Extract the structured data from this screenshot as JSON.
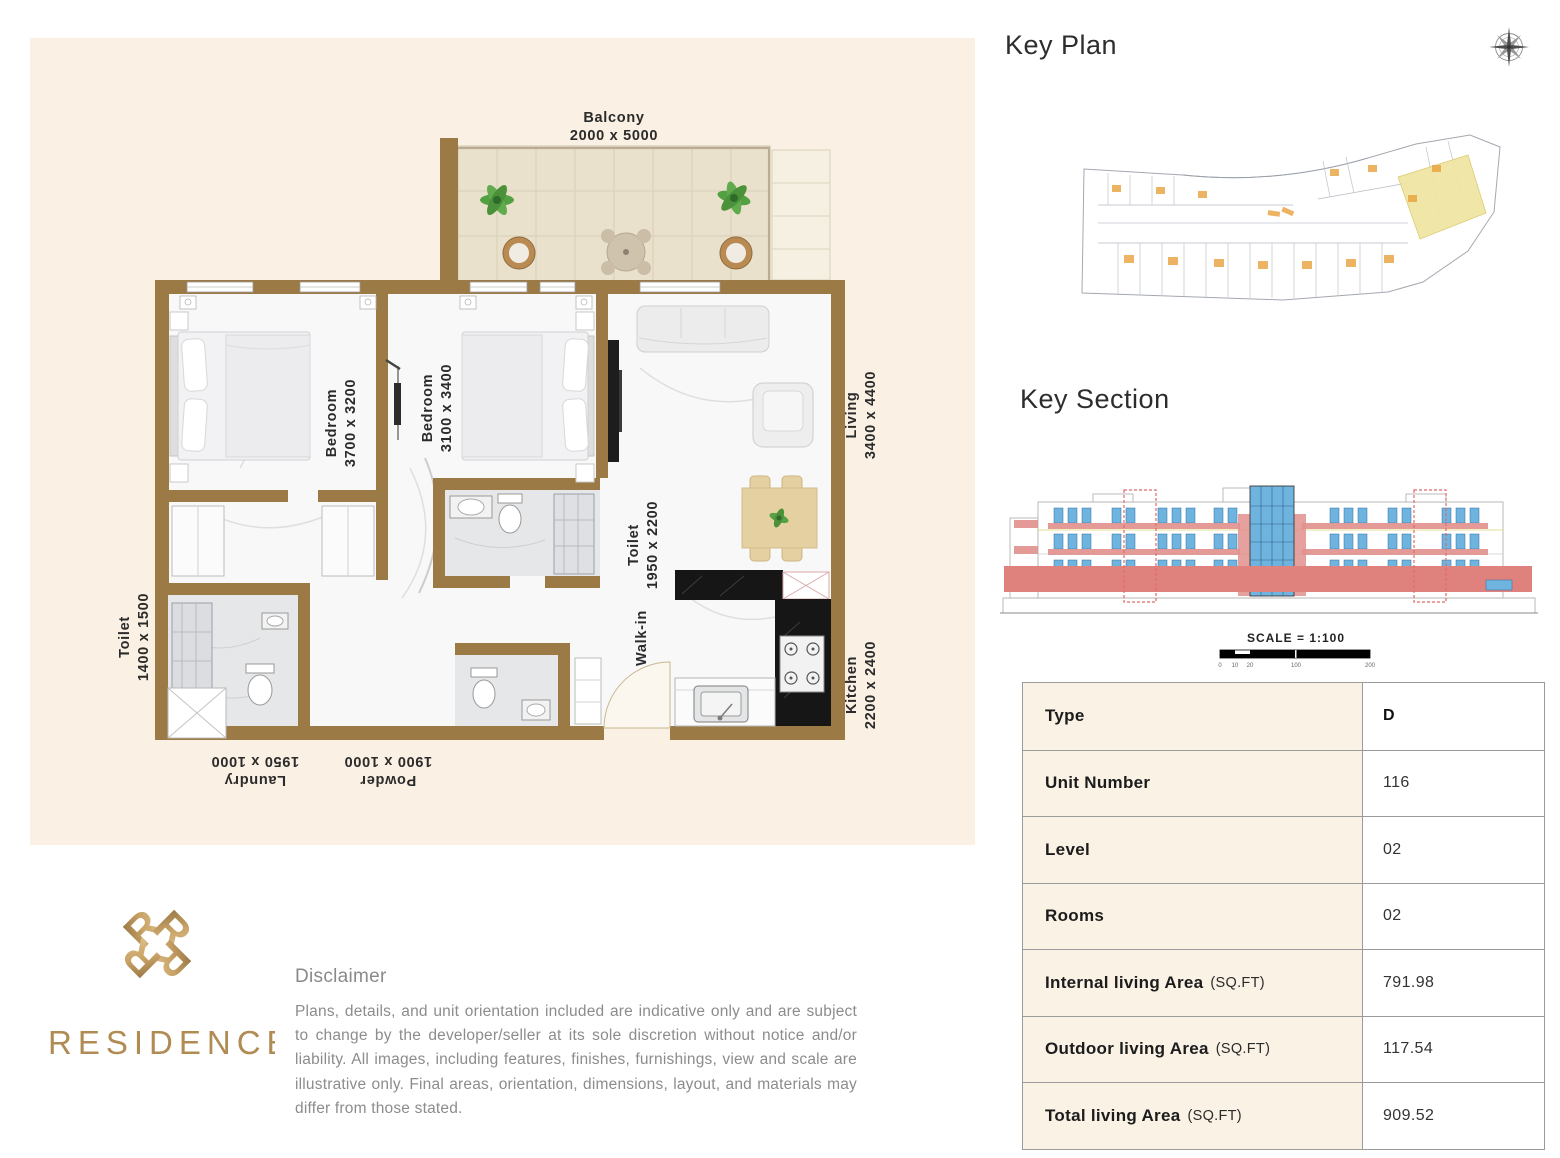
{
  "key_plan": {
    "title": "Key Plan"
  },
  "key_section": {
    "title": "Key Section",
    "scale_label": "SCALE = 1:100",
    "scale_ticks": [
      "0",
      "10",
      "20",
      "100",
      "200"
    ]
  },
  "floor_plan": {
    "balcony": {
      "name": "Balcony",
      "dims": "2000 x 5000"
    },
    "bedroom1": {
      "name": "Bedroom",
      "dims": "3700 x 3200"
    },
    "bedroom2": {
      "name": "Bedroom",
      "dims": "3100 x 3400"
    },
    "living": {
      "name": "Living",
      "dims": "3400 x 4400"
    },
    "toilet_ensuite": {
      "name": "Toilet",
      "dims": "1950 x 2200"
    },
    "toilet_small": {
      "name": "Toilet",
      "dims": "1400 x 1500"
    },
    "kitchen": {
      "name": "Kitchen",
      "dims": "2200 x 2400"
    },
    "walk_in": {
      "name": "Walk-in"
    },
    "laundry": {
      "name": "Laundry",
      "dims": "1950 x 1000"
    },
    "powder": {
      "name": "Powder",
      "dims": "1900 x 1000"
    }
  },
  "unit_table": {
    "rows": [
      {
        "label": "Type",
        "suffix": "",
        "value": "D"
      },
      {
        "label": "Unit Number",
        "suffix": "",
        "value": "116"
      },
      {
        "label": "Level",
        "suffix": "",
        "value": "02"
      },
      {
        "label": "Rooms",
        "suffix": "",
        "value": "02"
      },
      {
        "label": "Internal living Area",
        "suffix": "(SQ.FT)",
        "value": "791.98"
      },
      {
        "label": "Outdoor living Area",
        "suffix": "(SQ.FT)",
        "value": "117.54"
      },
      {
        "label": "Total living Area",
        "suffix": "(SQ.FT)",
        "value": "909.52"
      }
    ]
  },
  "brand": {
    "name": "RESIDENCE"
  },
  "disclaimer": {
    "heading": "Disclaimer",
    "body": "Plans, details, and unit orientation included are indicative only and are subject to change by the developer/seller at its sole discretion without notice and/or liability. All images, including features, finishes, furnishings, view and scale are illustrative only. Final areas, orientation, dimensions, layout, and materials may differ from those stated."
  },
  "colors": {
    "panel_cream": "#FAF1E4",
    "wall_brown": "#9C7A46",
    "balcony_tile": "#EAE1CC",
    "kitchen_black": "#161616",
    "section_pink": "#DF827E",
    "window_blue": "#6FB3DF",
    "highlight_yellow": "#EFE5A3",
    "plan_orange": "#E8A23C",
    "brand_gold": "#B08C54",
    "text_grey": "#8c8c8c"
  }
}
